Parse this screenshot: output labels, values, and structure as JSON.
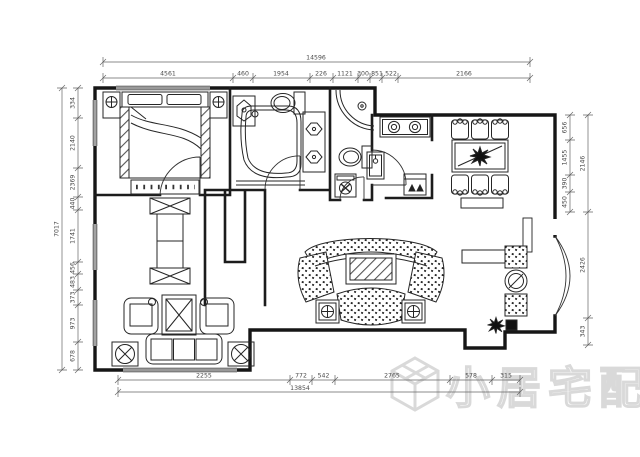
{
  "drawing": {
    "type": "apartment-floor-plan",
    "background": "#ffffff",
    "colors": {
      "walls": "#161616",
      "furniture": "#262626",
      "dimension_lines": "#666666",
      "watermark": "#d9d9d9"
    }
  },
  "dimensions": {
    "top": {
      "total": "14596",
      "segments": [
        "4561",
        "460",
        "1954",
        "226",
        "1121",
        "300",
        "851",
        "522",
        "2166"
      ]
    },
    "bottom": {
      "total": "13854",
      "segments": [
        "2255",
        "772",
        "542",
        "2765",
        "578",
        "315"
      ]
    },
    "left": {
      "total": "7017",
      "segments": [
        "334",
        "2140",
        "2369",
        "440",
        "1741",
        "456",
        "483",
        "373",
        "973",
        "678"
      ]
    },
    "right": {
      "inner_segments": [
        "656",
        "1455",
        "390",
        "450"
      ],
      "outer_segments": [
        "2146",
        "2426",
        "343"
      ]
    }
  },
  "watermark": {
    "icon": "cube-logo-icon",
    "text": "小居宅配"
  }
}
